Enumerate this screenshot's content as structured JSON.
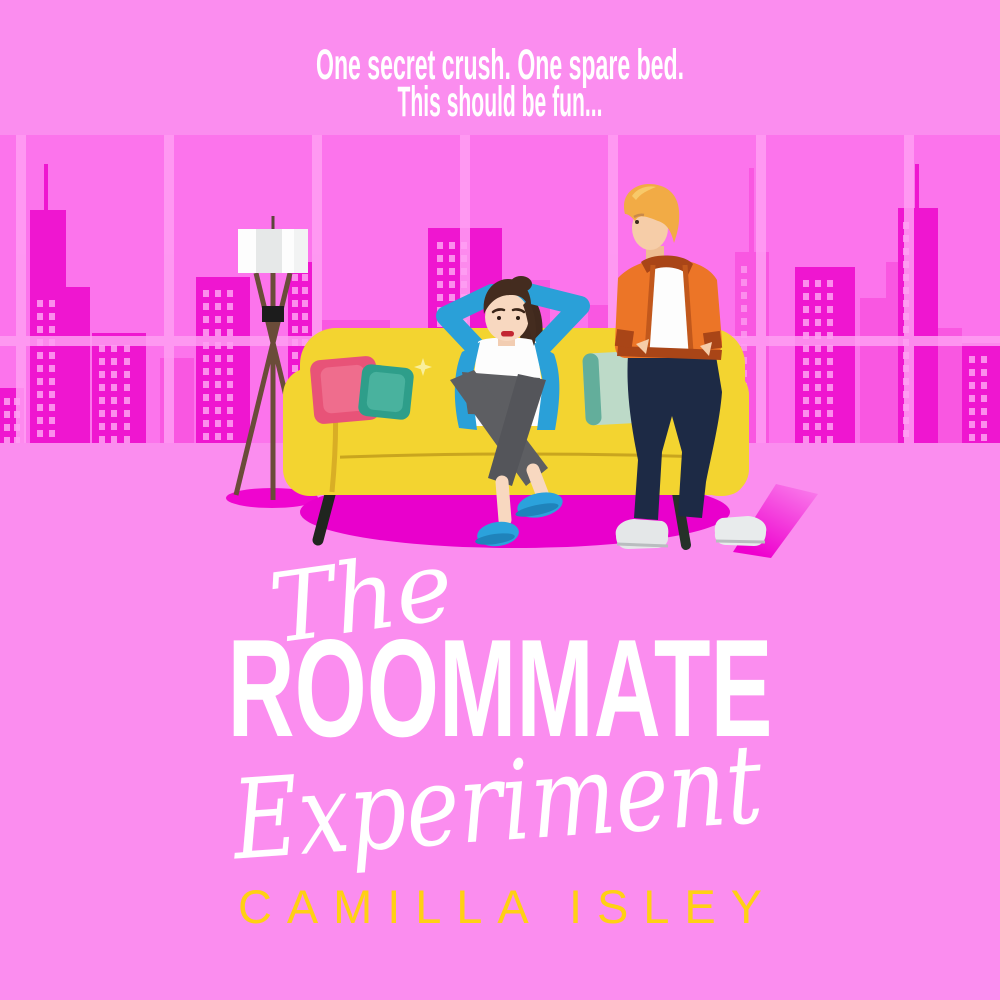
{
  "cover": {
    "tagline": {
      "line1": "One secret crush. One spare bed.",
      "line2": "This should be fun..."
    },
    "title": {
      "the": "The",
      "roommate": "ROOMMATE",
      "experiment": "Experiment"
    },
    "author": "CAMILLA ISLEY"
  },
  "colors": {
    "background": "#fb8def",
    "window_sky": "#fc74ec",
    "window_frame": "#ff9ff3",
    "skyline_back": "#f957e1",
    "skyline_front": "#ef16d0",
    "building_windows": "#fc8ded",
    "rug": "#e900cc",
    "sofa": "#f3d430",
    "sofa_seam": "#c9a51e",
    "pillow_pink": "#e85378",
    "pillow_teal": "#2e9e8a",
    "pillow_sage": "#bddac8",
    "lamp_shade": "#ffffff",
    "lamp_legs": "#6a4c39",
    "woman_cardigan": "#2aa0d8",
    "woman_pants": "#5d5e62",
    "woman_shoes": "#2ba2dc",
    "woman_hair": "#40291d",
    "man_jacket": "#ec7527",
    "man_jacket_trim": "#a94517",
    "man_pants": "#1d2a45",
    "man_shoes": "#e4e7e8",
    "man_hair": "#f2ab45",
    "title_color": "#ffffff",
    "author_color": "#ffd013"
  },
  "scene": {
    "elements": [
      "city-skyline",
      "window-frame",
      "floor-lamp",
      "area-rug",
      "yellow-sofa",
      "throw-pillows",
      "woman-relaxing-on-sofa",
      "man-standing-hands-in-pockets"
    ]
  }
}
